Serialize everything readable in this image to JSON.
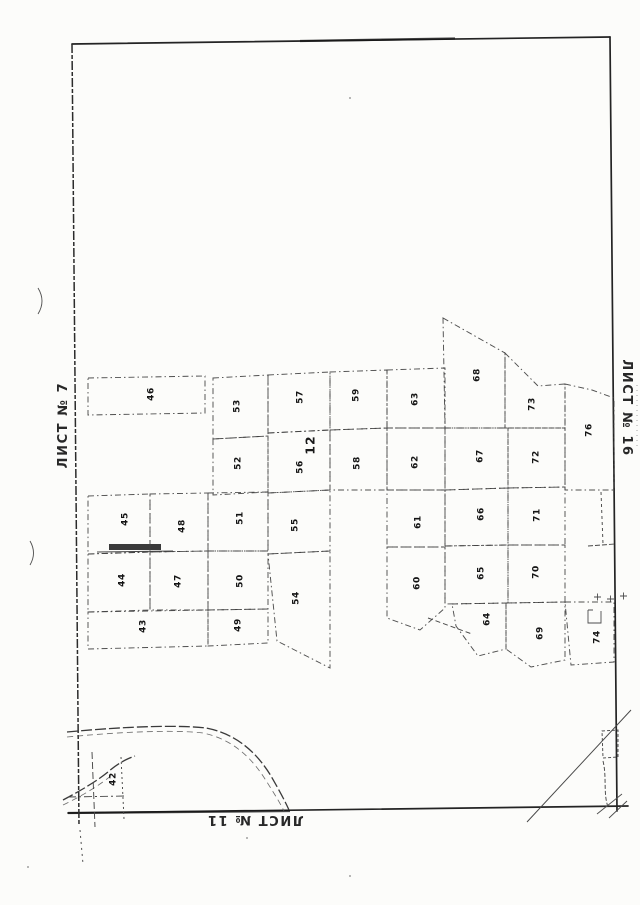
{
  "page": {
    "background": "#fcfcfa",
    "ink": "#2f2f2f"
  },
  "sheet_labels": {
    "left": "ЛИСТ № 7",
    "right": "ЛИСТ № 16",
    "bottom": "ЛИСТ № 11"
  },
  "map_data": {
    "type": "cadastral-plan",
    "quarter_label": {
      "text": "12",
      "x": 311,
      "y": 445
    },
    "plots": [
      {
        "n": "42",
        "label": [
          113,
          779
        ],
        "poly": null
      },
      {
        "n": "43",
        "label": [
          143,
          626
        ],
        "poly": [
          [
            88,
            612
          ],
          [
            208,
            610
          ],
          [
            208,
            646
          ],
          [
            88,
            649
          ]
        ]
      },
      {
        "n": "44",
        "label": [
          122,
          580
        ],
        "poly": [
          [
            88,
            554
          ],
          [
            150,
            552
          ],
          [
            150,
            610
          ],
          [
            88,
            612
          ]
        ]
      },
      {
        "n": "45",
        "label": [
          125,
          519
        ],
        "poly": [
          [
            88,
            496
          ],
          [
            150,
            494
          ],
          [
            150,
            552
          ],
          [
            88,
            554
          ]
        ]
      },
      {
        "n": "46",
        "label": [
          151,
          394
        ],
        "poly": [
          [
            88,
            378
          ],
          [
            205,
            376
          ],
          [
            205,
            413
          ],
          [
            88,
            415
          ]
        ]
      },
      {
        "n": "47",
        "label": [
          178,
          581
        ],
        "poly": [
          [
            150,
            552
          ],
          [
            208,
            551
          ],
          [
            208,
            610
          ],
          [
            150,
            610
          ]
        ]
      },
      {
        "n": "48",
        "label": [
          182,
          526
        ],
        "poly": [
          [
            150,
            494
          ],
          [
            208,
            493
          ],
          [
            208,
            551
          ],
          [
            150,
            552
          ]
        ]
      },
      {
        "n": "49",
        "label": [
          238,
          625
        ],
        "poly": [
          [
            208,
            610
          ],
          [
            268,
            609
          ],
          [
            268,
            643
          ],
          [
            208,
            646
          ]
        ]
      },
      {
        "n": "50",
        "label": [
          240,
          581
        ],
        "poly": [
          [
            208,
            551
          ],
          [
            268,
            551
          ],
          [
            268,
            609
          ],
          [
            208,
            610
          ]
        ]
      },
      {
        "n": "51",
        "label": [
          240,
          518
        ],
        "poly": [
          [
            208,
            493
          ],
          [
            268,
            492
          ],
          [
            268,
            551
          ],
          [
            208,
            551
          ]
        ]
      },
      {
        "n": "52",
        "label": [
          238,
          463
        ],
        "poly": [
          [
            213,
            439
          ],
          [
            268,
            436
          ],
          [
            268,
            492
          ],
          [
            213,
            495
          ]
        ]
      },
      {
        "n": "53",
        "label": [
          237,
          406
        ],
        "poly": [
          [
            213,
            378
          ],
          [
            268,
            375
          ],
          [
            268,
            436
          ],
          [
            213,
            439
          ]
        ]
      },
      {
        "n": "54",
        "label": [
          296,
          598
        ],
        "poly": [
          [
            268,
            554
          ],
          [
            330,
            551
          ],
          [
            330,
            668
          ],
          [
            277,
            641
          ]
        ]
      },
      {
        "n": "55",
        "label": [
          295,
          525
        ],
        "poly": [
          [
            268,
            493
          ],
          [
            330,
            490
          ],
          [
            330,
            551
          ],
          [
            268,
            554
          ]
        ]
      },
      {
        "n": "56",
        "label": [
          300,
          467
        ],
        "poly": [
          [
            268,
            433
          ],
          [
            330,
            430
          ],
          [
            330,
            490
          ],
          [
            268,
            493
          ]
        ]
      },
      {
        "n": "57",
        "label": [
          300,
          397
        ],
        "poly": [
          [
            268,
            375
          ],
          [
            330,
            372
          ],
          [
            330,
            430
          ],
          [
            268,
            433
          ]
        ]
      },
      {
        "n": "58",
        "label": [
          357,
          463
        ],
        "poly": [
          [
            330,
            430
          ],
          [
            387,
            428
          ],
          [
            387,
            490
          ],
          [
            330,
            490
          ]
        ]
      },
      {
        "n": "59",
        "label": [
          356,
          395
        ],
        "poly": [
          [
            330,
            372
          ],
          [
            387,
            370
          ],
          [
            387,
            428
          ],
          [
            330,
            430
          ]
        ]
      },
      {
        "n": "60",
        "label": [
          417,
          583
        ],
        "poly": [
          [
            387,
            547
          ],
          [
            445,
            547
          ],
          [
            445,
            608
          ],
          [
            420,
            630
          ],
          [
            387,
            618
          ]
        ]
      },
      {
        "n": "61",
        "label": [
          418,
          522
        ],
        "poly": [
          [
            387,
            490
          ],
          [
            445,
            490
          ],
          [
            445,
            547
          ],
          [
            387,
            547
          ]
        ]
      },
      {
        "n": "62",
        "label": [
          415,
          462
        ],
        "poly": [
          [
            387,
            428
          ],
          [
            445,
            428
          ],
          [
            445,
            490
          ],
          [
            387,
            490
          ]
        ]
      },
      {
        "n": "63",
        "label": [
          415,
          399
        ],
        "poly": [
          [
            387,
            370
          ],
          [
            445,
            368
          ],
          [
            445,
            428
          ],
          [
            387,
            428
          ]
        ]
      },
      {
        "n": "64",
        "label": [
          487,
          619
        ],
        "poly": [
          [
            452,
            604
          ],
          [
            506,
            603
          ],
          [
            506,
            649
          ],
          [
            478,
            656
          ],
          [
            456,
            626
          ]
        ]
      },
      {
        "n": "65",
        "label": [
          481,
          573
        ],
        "poly": [
          [
            445,
            546
          ],
          [
            508,
            545
          ],
          [
            508,
            603
          ],
          [
            445,
            604
          ]
        ]
      },
      {
        "n": "66",
        "label": [
          481,
          514
        ],
        "poly": [
          [
            445,
            490
          ],
          [
            508,
            488
          ],
          [
            508,
            545
          ],
          [
            445,
            546
          ]
        ]
      },
      {
        "n": "67",
        "label": [
          480,
          456
        ],
        "poly": [
          [
            445,
            428
          ],
          [
            508,
            428
          ],
          [
            508,
            488
          ],
          [
            445,
            490
          ]
        ]
      },
      {
        "n": "68",
        "label": [
          477,
          375
        ],
        "poly": [
          [
            443,
            318
          ],
          [
            505,
            353
          ],
          [
            505,
            428
          ],
          [
            445,
            428
          ]
        ]
      },
      {
        "n": "69",
        "label": [
          540,
          633
        ],
        "poly": [
          [
            506,
            603
          ],
          [
            565,
            602
          ],
          [
            565,
            660
          ],
          [
            531,
            667
          ],
          [
            506,
            649
          ]
        ]
      },
      {
        "n": "70",
        "label": [
          536,
          572
        ],
        "poly": [
          [
            508,
            545
          ],
          [
            565,
            545
          ],
          [
            565,
            602
          ],
          [
            508,
            603
          ]
        ]
      },
      {
        "n": "71",
        "label": [
          537,
          515
        ],
        "poly": [
          [
            508,
            488
          ],
          [
            565,
            487
          ],
          [
            565,
            545
          ],
          [
            508,
            545
          ]
        ]
      },
      {
        "n": "72",
        "label": [
          536,
          457
        ],
        "poly": [
          [
            508,
            428
          ],
          [
            565,
            428
          ],
          [
            565,
            487
          ],
          [
            508,
            488
          ]
        ]
      },
      {
        "n": "73",
        "label": [
          532,
          404
        ],
        "poly": [
          [
            505,
            353
          ],
          [
            538,
            386
          ],
          [
            565,
            384
          ],
          [
            565,
            428
          ],
          [
            505,
            428
          ]
        ]
      },
      {
        "n": "74",
        "label": [
          597,
          637
        ],
        "poly": [
          [
            565,
            602
          ],
          [
            614,
            602
          ],
          [
            614,
            662
          ],
          [
            571,
            665
          ]
        ]
      },
      {
        "n": "76",
        "label": [
          589,
          430
        ],
        "poly": [
          [
            565,
            384
          ],
          [
            592,
            390
          ],
          [
            614,
            398
          ],
          [
            614,
            490
          ],
          [
            565,
            490
          ]
        ]
      }
    ]
  }
}
